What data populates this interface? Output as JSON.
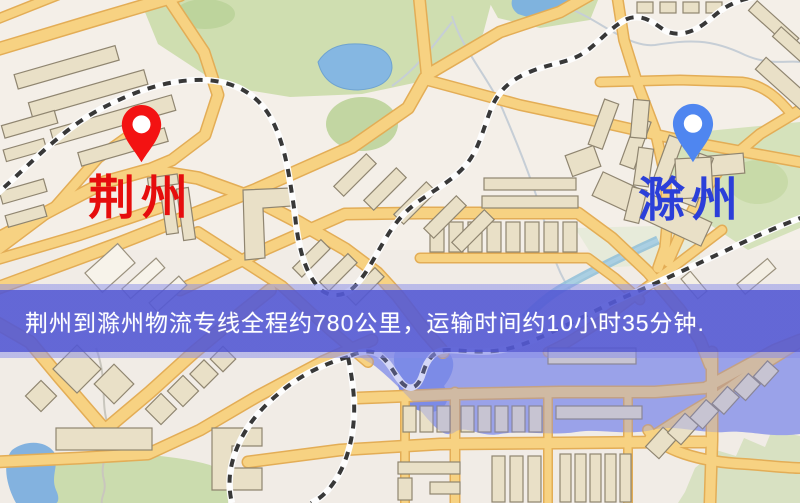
{
  "page": {
    "type": "logistics-route-map"
  },
  "banner": {
    "text": "荆州到滁州物流专线全程约780公里，运输时间约10小时35分钟.",
    "background": "#565bd5",
    "text_color": "#ffffff"
  },
  "route": {
    "origin": "荆州",
    "destination": "滁州",
    "distance_text": "约780公里",
    "duration_text": "约10小时35分钟"
  },
  "markers": {
    "origin": {
      "label": "荆州",
      "label_color": "#e60d0d",
      "pin_color": "#f31212",
      "pin_icon": "red-map-pin-icon"
    },
    "destination": {
      "label": "滁州",
      "label_color": "#2b3fd9",
      "pin_color": "#4f86f0",
      "pin_icon": "blue-map-pin-icon"
    }
  },
  "map": {
    "colors": {
      "base": "#f4efe8",
      "road_fill": "#f7d282",
      "road_casing": "#e3ad56",
      "park": "#cfdeb0",
      "pond": "#85b7e2",
      "water_region": "#a7aee9",
      "lake": "#7b8ce6",
      "building": "#e9e0c7",
      "building_outline": "#8f8570",
      "railway": "#383838",
      "stream": "#c6ced6"
    }
  }
}
